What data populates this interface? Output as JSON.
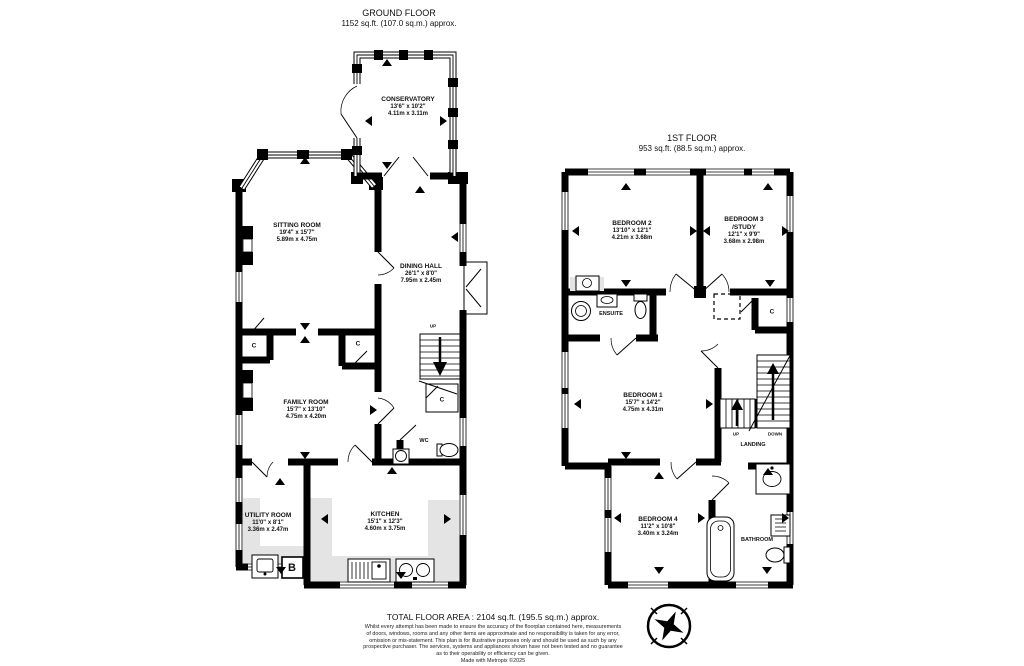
{
  "ground_floor": {
    "title": "GROUND FLOOR",
    "subtitle": "1152 sq.ft. (107.0 sq.m.) approx.",
    "rooms": {
      "conservatory": {
        "name": "CONSERVATORY",
        "size_ft": "13'6\" x 10'2\"",
        "size_m": "4.11m x 3.11m"
      },
      "sitting_room": {
        "name": "SITTING ROOM",
        "size_ft": "19'4\" x 15'7\"",
        "size_m": "5.89m x 4.75m"
      },
      "dining_hall": {
        "name": "DINING HALL",
        "size_ft": "26'1\" x 8'0\"",
        "size_m": "7.95m x 2.45m"
      },
      "family_room": {
        "name": "FAMILY ROOM",
        "size_ft": "15'7\" x 13'10\"",
        "size_m": "4.75m x 4.20m"
      },
      "utility_room": {
        "name": "UTILITY ROOM",
        "size_ft": "11'0\" x 8'1\"",
        "size_m": "3.36m x 2.47m"
      },
      "kitchen": {
        "name": "KITCHEN",
        "size_ft": "15'1\" x 12'3\"",
        "size_m": "4.60m x 3.75m"
      }
    },
    "labels": {
      "wc": "WC",
      "up": "UP",
      "closet": "C",
      "boiler": "B"
    }
  },
  "first_floor": {
    "title": "1ST FLOOR",
    "subtitle": "953 sq.ft. (88.5 sq.m.) approx.",
    "rooms": {
      "bedroom_1": {
        "name": "BEDROOM 1",
        "size_ft": "15'7\" x 14'2\"",
        "size_m": "4.75m x 4.31m"
      },
      "bedroom_2": {
        "name": "BEDROOM 2",
        "size_ft": "13'10\" x 12'1\"",
        "size_m": "4.21m x 3.68m"
      },
      "bedroom_3": {
        "name": "BEDROOM 3",
        "name_suffix": "/STUDY",
        "size_ft": "12'1\" x 9'9\"",
        "size_m": "3.68m x 2.98m"
      },
      "bedroom_4": {
        "name": "BEDROOM 4",
        "size_ft": "11'2\" x 10'8\"",
        "size_m": "3.40m x 3.24m"
      },
      "ensuite": {
        "name": "ENSUITE"
      },
      "bathroom": {
        "name": "BATHROOM"
      },
      "landing": {
        "name": "LANDING"
      }
    },
    "labels": {
      "up": "UP",
      "down": "DOWN",
      "closet": "C"
    }
  },
  "footer": {
    "total": "TOTAL FLOOR AREA : 2104 sq.ft. (195.5 sq.m.) approx.",
    "disclaimer_lines": [
      "Whilst every attempt has been made to ensure the accuracy of the floorplan contained here, measurements",
      "of doors, windows, rooms and any other items are approximate and no responsibility is taken for any error,",
      "omission or mis-statement. This plan is for illustrative purposes only and should be used as such by any",
      "prospective purchaser. The services, systems and appliances shown have not been tested and no guarantee",
      "as to their operability or efficiency can be given."
    ],
    "made_with": "Made with Metropix ©2025"
  }
}
